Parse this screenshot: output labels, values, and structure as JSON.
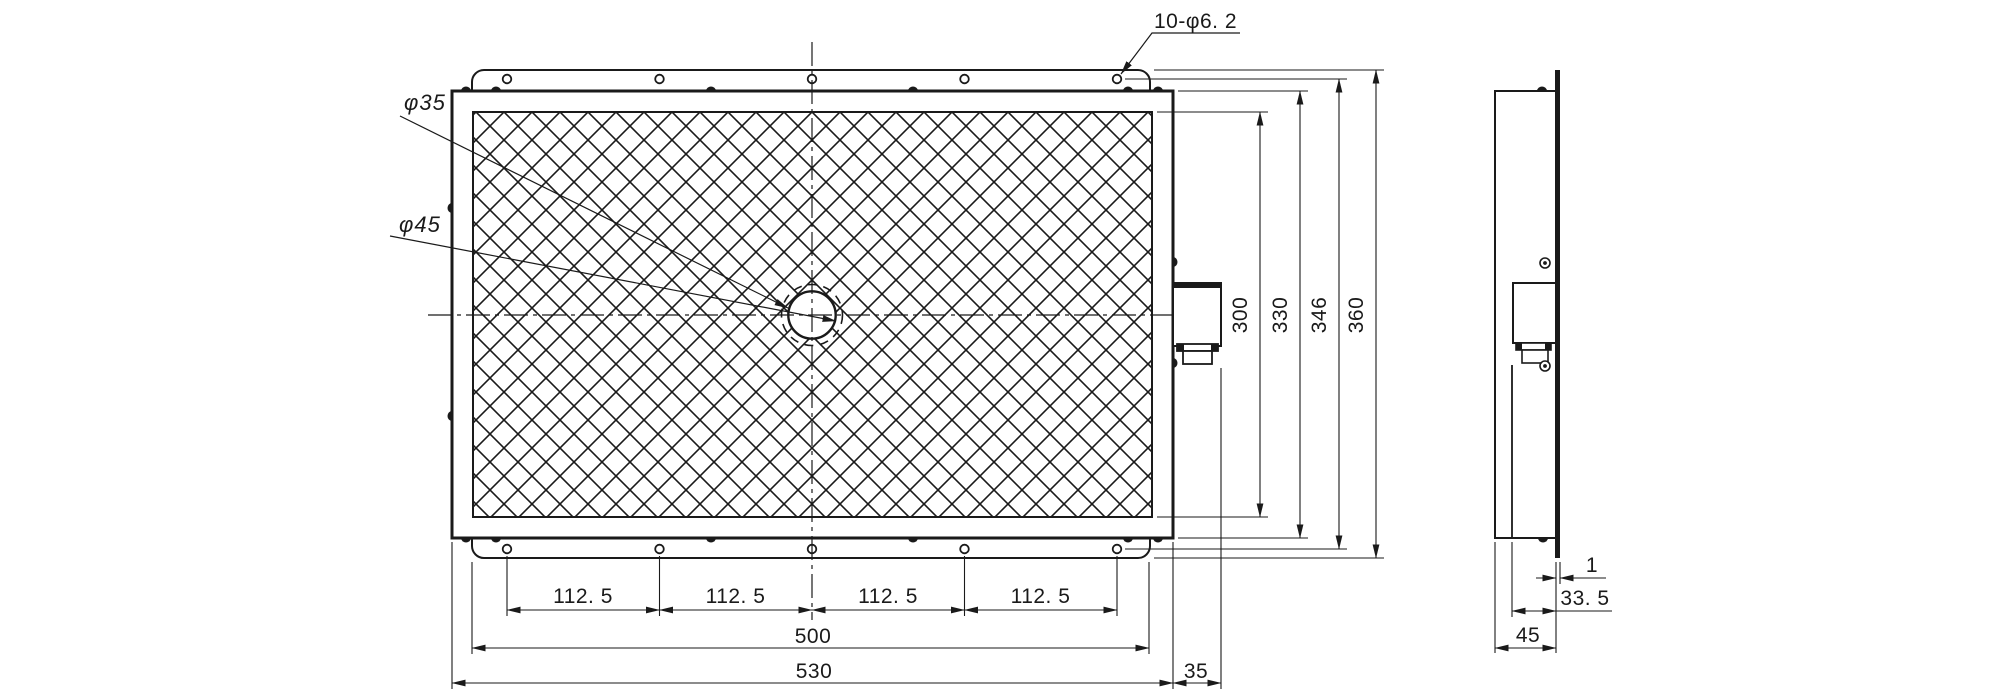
{
  "front_view": {
    "hole_note": "10-φ6. 2",
    "inner_circle_label": "φ35",
    "outer_circle_label": "φ45",
    "pitch_dims": [
      "112. 5",
      "112. 5",
      "112. 5",
      "112. 5"
    ],
    "flange_width": "500",
    "overall_width": "530",
    "protrusion_depth": "35",
    "mesh_height": "300",
    "panel_height": "330",
    "hole_pitch_height": "346",
    "flange_height": "360"
  },
  "side_view": {
    "flange_thickness": "1",
    "flange_offset": "33. 5",
    "overall_depth": "45"
  },
  "colors": {
    "line": "#1a1a1a",
    "background": "#ffffff"
  }
}
